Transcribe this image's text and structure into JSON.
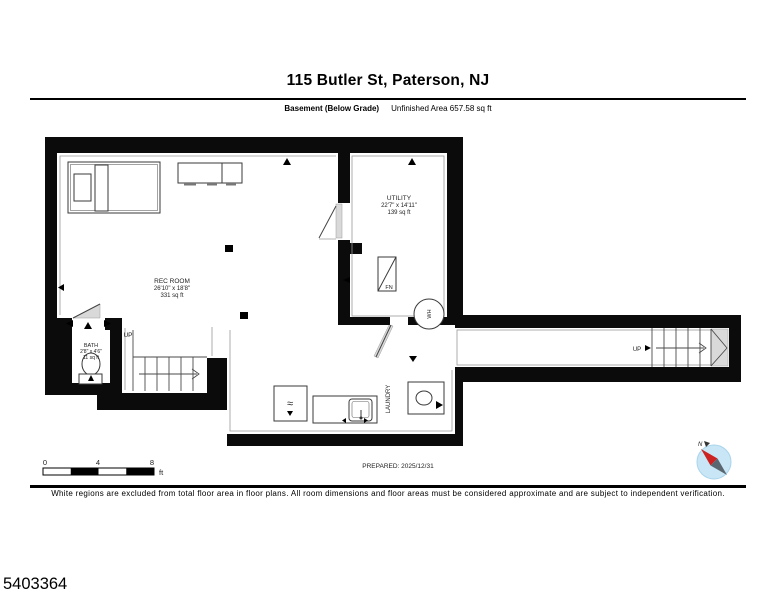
{
  "header": {
    "title": "115 Butler St, Paterson, NJ",
    "floor_label": "Basement (Below Grade)",
    "area_label": "Unfinished Area 657.58 sq ft"
  },
  "plan": {
    "rooms": {
      "rec_room": {
        "name": "REC ROOM",
        "dims": "26'10\" x 18'8\"",
        "area": "331 sq ft"
      },
      "utility": {
        "name": "UTILITY",
        "dims": "22'7\" x 14'11\"",
        "area": "139 sq ft"
      },
      "bath": {
        "name": "BATH",
        "dims": "2'8\" x 4'6\"",
        "area": "11 sq ft"
      },
      "laundry": {
        "name": "LAUNDRY"
      }
    },
    "labels": {
      "up": "UP",
      "furnace": "FN",
      "water_heater": "WH",
      "compass_north": "N"
    }
  },
  "footer": {
    "scale": {
      "ticks": [
        "0",
        "4",
        "8"
      ],
      "unit": "ft"
    },
    "prepared": "PREPARED: 2025/12/31",
    "disclaimer": "White regions are excluded from total floor area in floor plans. All room dimensions and floor areas must be considered approximate and are subject to independent verification.",
    "mls_number": "5403364"
  }
}
